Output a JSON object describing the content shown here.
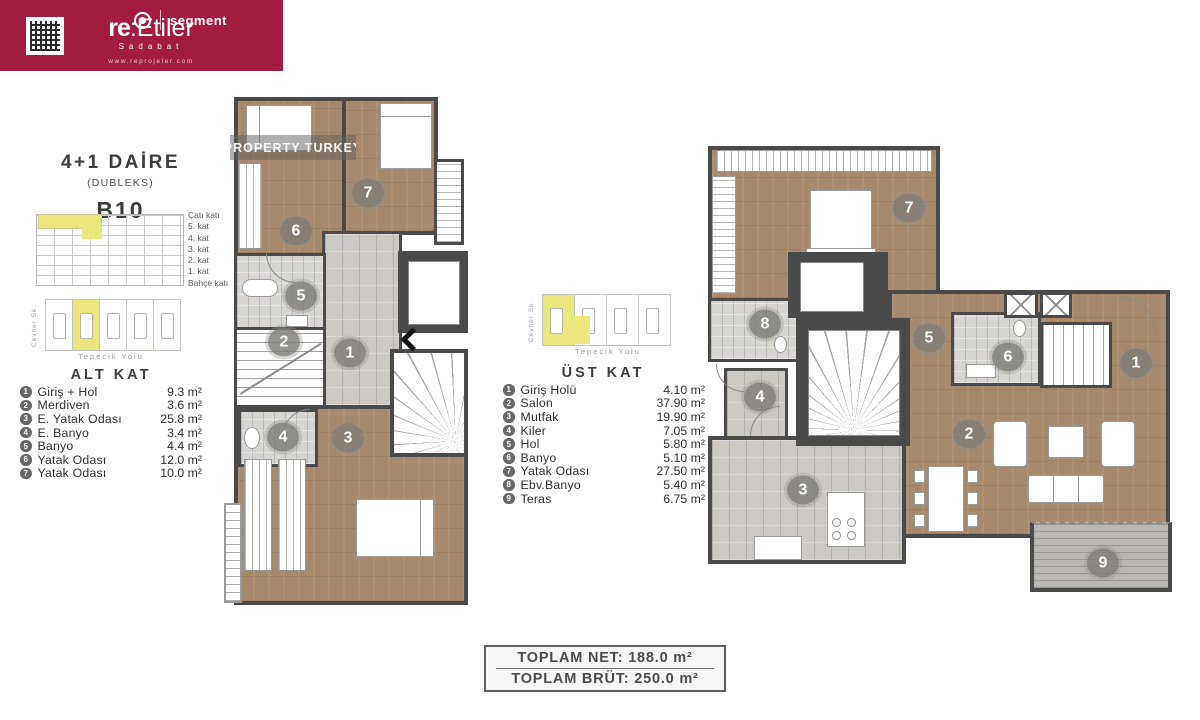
{
  "banner": {
    "brand_bold": "re",
    "brand_rest": ":Etiler",
    "subtitle": "Sadabat",
    "website": "www.reprojeler.com",
    "partner": "segment"
  },
  "unit": {
    "title": "4+1 DAİRE",
    "type": "(DUBLEKS)",
    "code": "B10"
  },
  "elevation_floors": [
    "Çatı katı",
    "5. kat",
    "4. kat",
    "3. kat",
    "2. kat",
    "1. kat",
    "Bahçe katı"
  ],
  "site": {
    "side_street": "Cevher Sk.",
    "front_street": "Tepecik Yolu"
  },
  "lower": {
    "heading": "ALT KAT",
    "rooms": [
      {
        "no": "1",
        "name": "Giriş + Hol",
        "area": "9.3 m²"
      },
      {
        "no": "2",
        "name": "Merdiven",
        "area": "3.6 m²"
      },
      {
        "no": "3",
        "name": "E. Yatak Odası",
        "area": "25.8 m²"
      },
      {
        "no": "4",
        "name": "E. Banyo",
        "area": "3.4 m²"
      },
      {
        "no": "5",
        "name": "Banyo",
        "area": "4.4 m²"
      },
      {
        "no": "6",
        "name": "Yatak Odası",
        "area": "12.0 m²"
      },
      {
        "no": "7",
        "name": "Yatak Odası",
        "area": "10.0 m²"
      }
    ]
  },
  "upper": {
    "heading": "ÜST KAT",
    "rooms": [
      {
        "no": "1",
        "name": "Giriş Holü",
        "area": "4.10 m²"
      },
      {
        "no": "2",
        "name": "Salon",
        "area": "37.90 m²"
      },
      {
        "no": "3",
        "name": "Mutfak",
        "area": "19.90 m²"
      },
      {
        "no": "4",
        "name": "Kiler",
        "area": "7.05 m²"
      },
      {
        "no": "5",
        "name": "Hol",
        "area": "5.80 m²"
      },
      {
        "no": "6",
        "name": "Banyo",
        "area": "5.10 m²"
      },
      {
        "no": "7",
        "name": "Yatak Odası",
        "area": "27.50 m²"
      },
      {
        "no": "8",
        "name": "Ebv.Banyo",
        "area": "5.40 m²"
      },
      {
        "no": "9",
        "name": "Teras",
        "area": "6.75 m²"
      }
    ]
  },
  "totals": {
    "net": "TOPLAM NET: 188.0 m²",
    "brut": "TOPLAM BRÜT: 250.0 m²"
  },
  "watermark": "PROPERTY TURKEY",
  "colors": {
    "banner": "#a21c41",
    "highlight": "#e9e67c",
    "wall": "#4a4a4a",
    "wood": "#a8896b",
    "tile": "#ccc9c4"
  }
}
